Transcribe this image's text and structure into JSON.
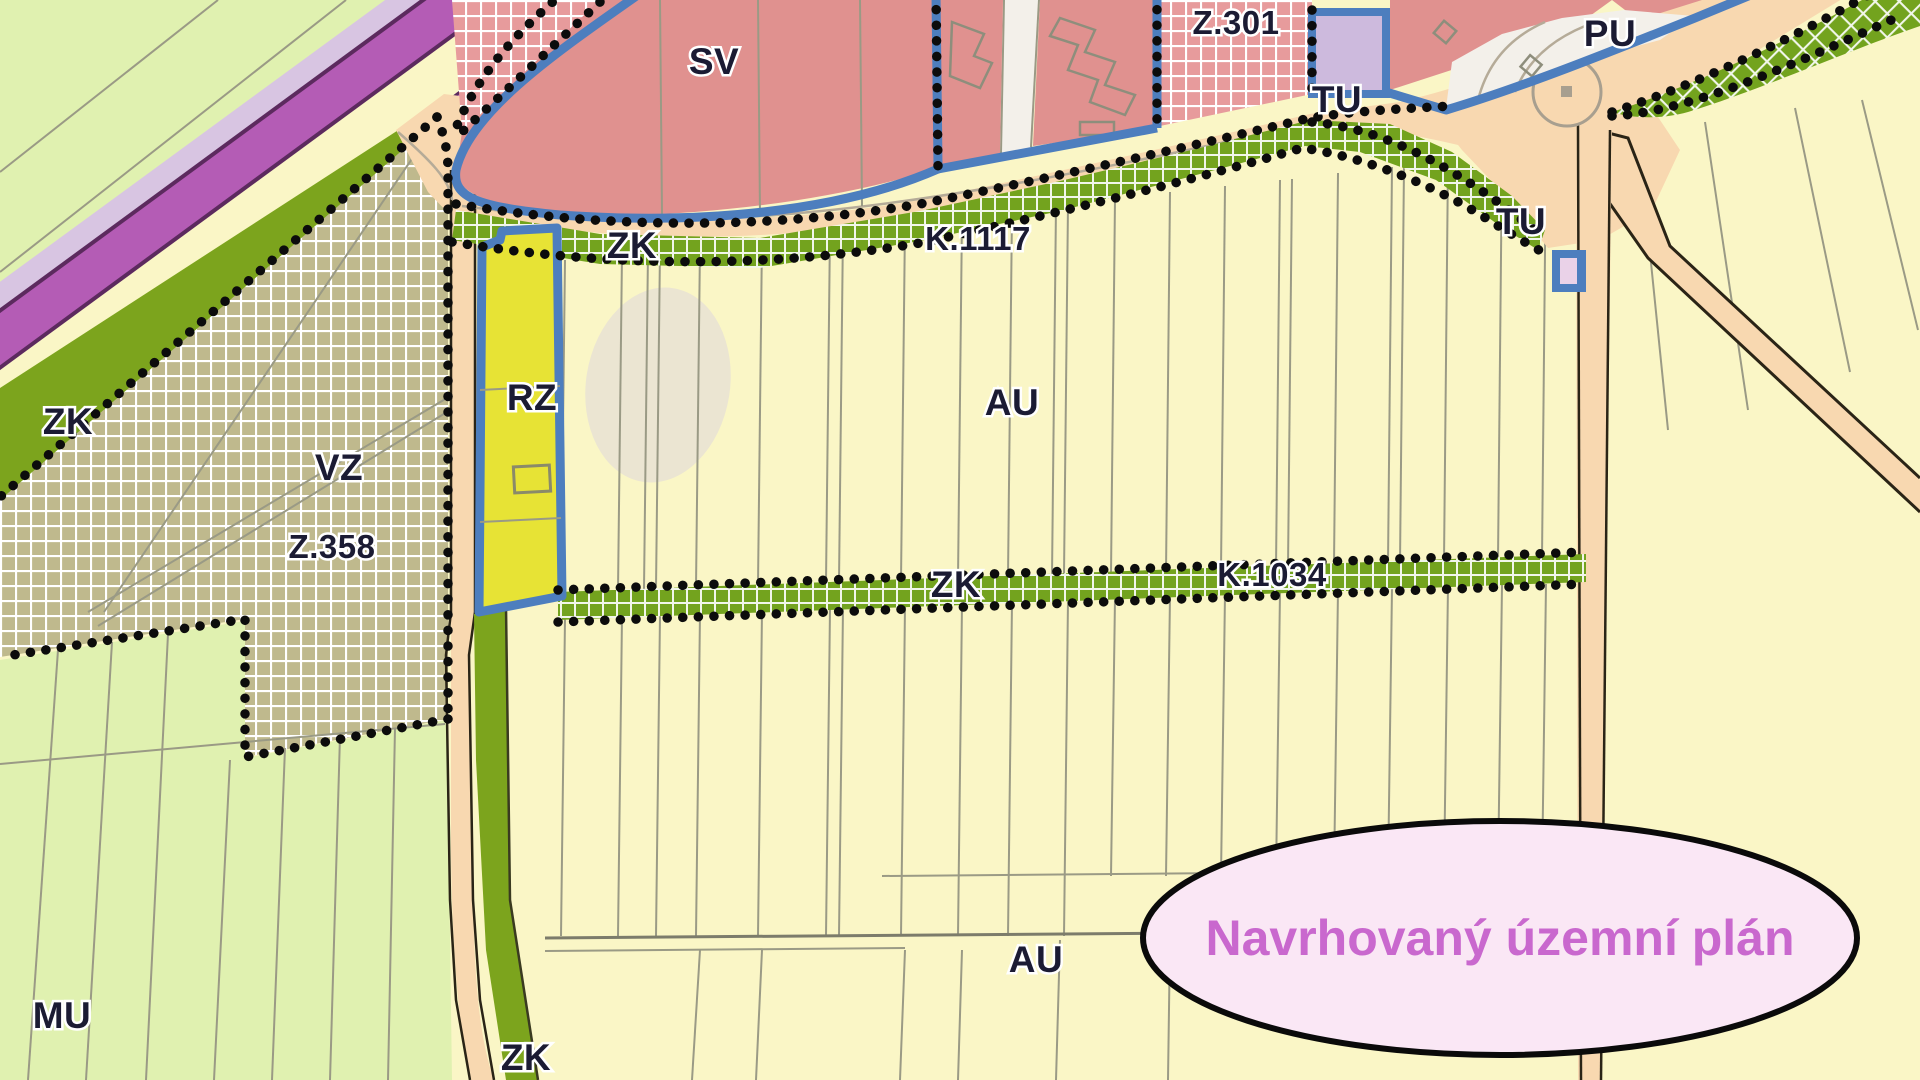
{
  "map": {
    "labels": [
      {
        "id": "zk-upper-left",
        "text": "ZK"
      },
      {
        "id": "vz",
        "text": "VZ"
      },
      {
        "id": "z358",
        "text": "Z.358"
      },
      {
        "id": "rz",
        "text": "RZ"
      },
      {
        "id": "zk-top",
        "text": "ZK"
      },
      {
        "id": "sv",
        "text": "SV"
      },
      {
        "id": "k1117",
        "text": "K.1117"
      },
      {
        "id": "z301",
        "text": "Z.301"
      },
      {
        "id": "tu-top",
        "text": "TU"
      },
      {
        "id": "pu",
        "text": "PU"
      },
      {
        "id": "tu-right",
        "text": "TU"
      },
      {
        "id": "au-upper",
        "text": "AU"
      },
      {
        "id": "zk-mid",
        "text": "ZK"
      },
      {
        "id": "k1034",
        "text": "K.1034"
      },
      {
        "id": "mu",
        "text": "MU"
      },
      {
        "id": "au-lower",
        "text": "AU"
      },
      {
        "id": "zk-bottom",
        "text": "ZK"
      }
    ],
    "annotation": {
      "text": "Navrhovaný územní plán"
    }
  },
  "palette": {
    "yellow": "#FAF6C6",
    "lgreen": "#E0F1B0",
    "khaki": "#BFB98D",
    "olive": "#7CA41D",
    "green": "#73A31E",
    "tan": "#F8D8B0",
    "pink": "#E0918F",
    "pinkhatch": "#E79B9C",
    "magenta": "#B45CB5",
    "lavender": "#D8C5E2",
    "lavbox": "#CDBADD",
    "blue": "#4D7EBE",
    "ryellow": "#E7E335",
    "white": "#F3F0EA",
    "beige": "#EBE5D2",
    "label": "#1b1b33",
    "annot_fill": "#FAE7F5",
    "annot_text": "#C968CE",
    "parcel": "#9a9a85"
  }
}
